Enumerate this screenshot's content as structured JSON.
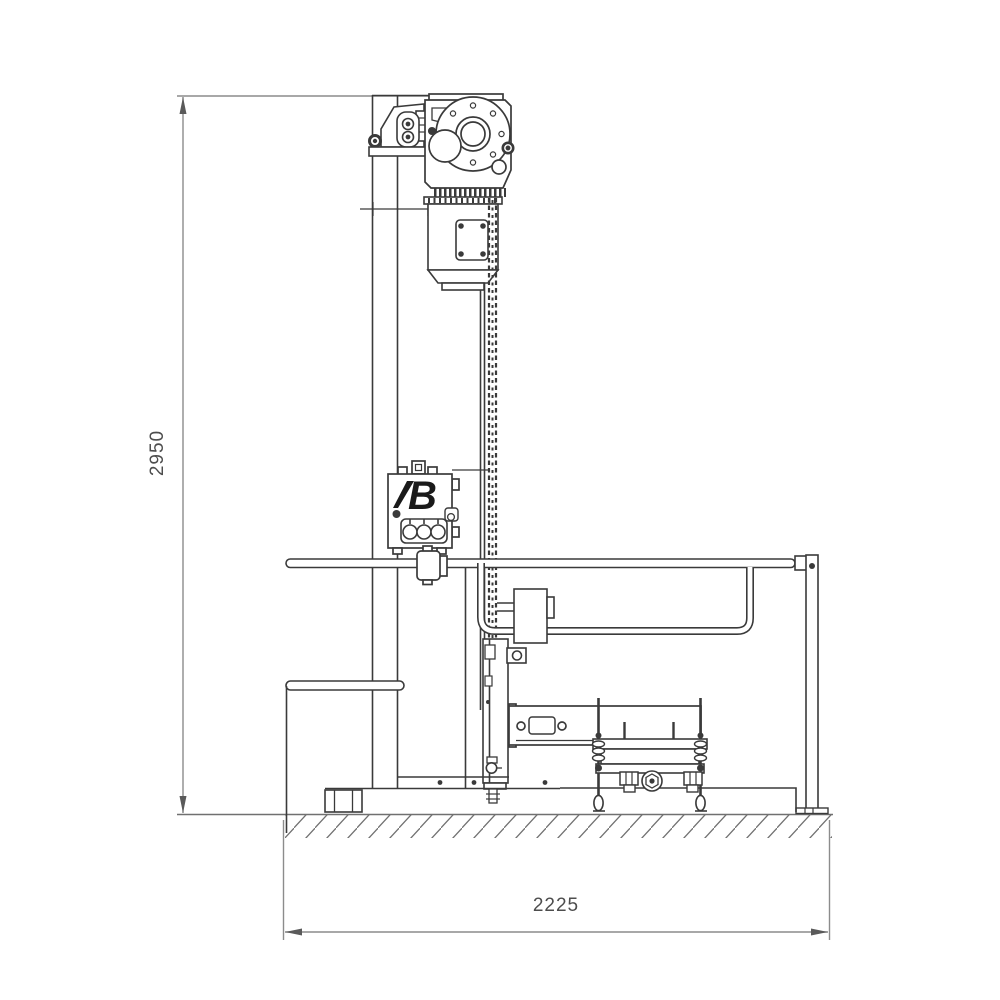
{
  "drawing": {
    "type": "technical-side-elevation",
    "machine": "column-lifter-with-guard-rails",
    "dimensions": {
      "height": "2950",
      "width": "2225"
    },
    "logo_text": "B",
    "colors": {
      "line": "#3a3a3a",
      "dimension": "#8c8c8c",
      "ground": "#707070",
      "background": "#ffffff"
    }
  }
}
